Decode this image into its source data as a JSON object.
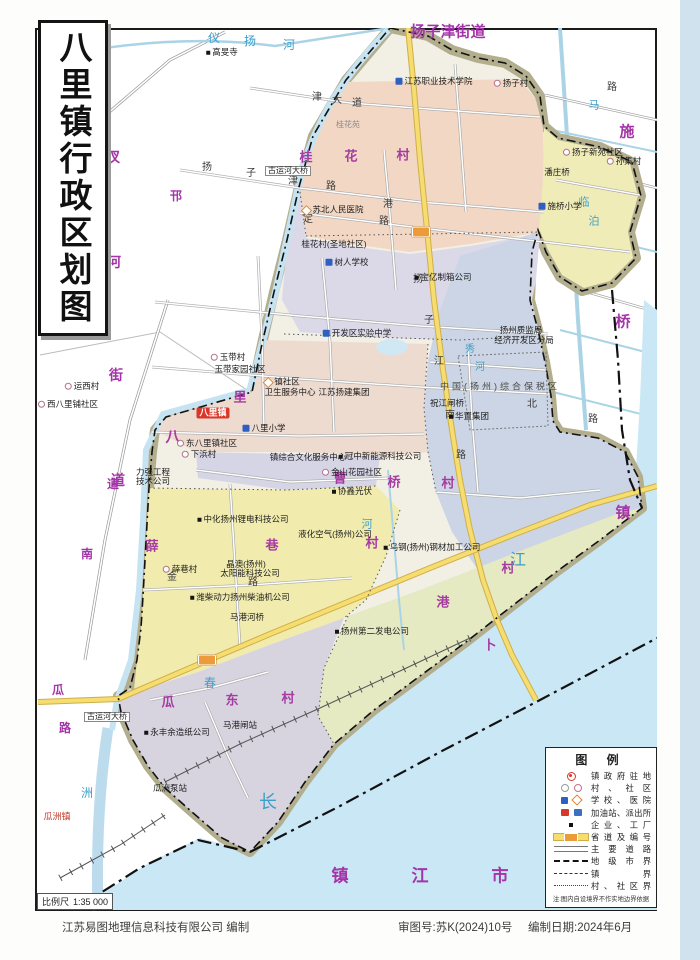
{
  "page": {
    "title": "八里镇行政区划图",
    "scale_label": "比例尺",
    "scale_value": "1:35 000",
    "credits": {
      "publisher": "江苏易图地理信息科技有限公司  编制",
      "approval": "审图号:苏K(2024)10号",
      "date": "编制日期:2024年6月"
    }
  },
  "colors": {
    "admin_purple": "#a335a8",
    "water_blue": "#c9e7f4",
    "levee_khaki": "#b2ae8e",
    "provincial_road_yellow": "#f6dd70",
    "shield_orange": "#ec9b3b",
    "seat_red": "#d8372a",
    "region_pink": "#f2d8c4",
    "region_yellow": "#f1ecae",
    "region_lavender": "#dbd9e8",
    "region_bluegray": "#ccd5e5",
    "region_green": "#e6eac2"
  },
  "legend": {
    "title": "图  例",
    "items": [
      {
        "icon": "govt",
        "label": "镇政府驻地"
      },
      {
        "icon": "village",
        "label": "村、社区"
      },
      {
        "icon": "school-hosp",
        "label": "学校、医院"
      },
      {
        "icon": "gas-police",
        "label": "加油站、派出所"
      },
      {
        "icon": "factory",
        "label": "企业、工厂"
      },
      {
        "icon": "sroad",
        "label": "省道及编号"
      },
      {
        "icon": "road",
        "label": "主要道路"
      },
      {
        "icon": "cityline",
        "label": "地级市界"
      },
      {
        "icon": "townline",
        "label": "镇界"
      },
      {
        "icon": "villine",
        "label": "村、社区界"
      }
    ],
    "note": "注:图内自设境界不作实地边界依据"
  },
  "map": {
    "admin_names": [
      {
        "name": "扬子津街道",
        "cls": "adm-lg",
        "chars": [
          {
            "c": "扬子津街道",
            "x": 448,
            "y": 32
          }
        ]
      },
      {
        "name": "汊河街道",
        "chars": [
          {
            "c": "汊",
            "x": 113,
            "y": 157
          },
          {
            "c": "河",
            "x": 114,
            "y": 262
          },
          {
            "c": "街",
            "x": 116,
            "y": 375
          },
          {
            "c": "道",
            "x": 118,
            "y": 480
          }
        ]
      },
      {
        "name": "施桥镇",
        "cls": "adm-lg",
        "chars": [
          {
            "c": "施",
            "x": 627,
            "y": 132
          },
          {
            "c": "桥",
            "x": 623,
            "y": 322
          },
          {
            "c": "镇",
            "x": 623,
            "y": 513
          }
        ]
      },
      {
        "name": "镇江市",
        "cls": "adm-city",
        "chars": [
          {
            "c": "镇",
            "x": 340,
            "y": 876
          },
          {
            "c": "江",
            "x": 420,
            "y": 876
          },
          {
            "c": "市",
            "x": 500,
            "y": 876
          }
        ]
      },
      {
        "name": "邗江",
        "chars": [
          {
            "c": "邗",
            "x": 176,
            "y": 196,
            "s": 12
          }
        ]
      },
      {
        "name": "瓜洲镇",
        "chars": [
          {
            "c": "镇",
            "x": 44,
            "y": 901,
            "s": 13
          }
        ]
      }
    ],
    "region_names": [
      {
        "name": "桂花村",
        "chars": [
          {
            "c": "桂",
            "x": 306,
            "y": 157
          },
          {
            "c": "花",
            "x": 351,
            "y": 156
          },
          {
            "c": "村",
            "x": 403,
            "y": 155
          }
        ]
      },
      {
        "name": "八里",
        "chars": [
          {
            "c": "八",
            "x": 173,
            "y": 437,
            "s": 15
          },
          {
            "c": "里",
            "x": 240,
            "y": 397
          }
        ]
      },
      {
        "name": "薛巷村",
        "chars": [
          {
            "c": "薛",
            "x": 152,
            "y": 546
          },
          {
            "c": "巷",
            "x": 272,
            "y": 545
          },
          {
            "c": "村",
            "x": 372,
            "y": 543
          }
        ]
      },
      {
        "name": "曹桥村",
        "chars": [
          {
            "c": "曹",
            "x": 340,
            "y": 478
          },
          {
            "c": "桥",
            "x": 394,
            "y": 482
          },
          {
            "c": "村",
            "x": 448,
            "y": 483
          }
        ]
      },
      {
        "name": "瓜东村",
        "chars": [
          {
            "c": "瓜",
            "x": 168,
            "y": 702
          },
          {
            "c": "东",
            "x": 232,
            "y": 700
          },
          {
            "c": "村",
            "x": 288,
            "y": 698
          }
        ]
      },
      {
        "name": "卜港村",
        "chars": [
          {
            "c": "村",
            "x": 508,
            "y": 568
          },
          {
            "c": "港",
            "x": 443,
            "y": 602
          },
          {
            "c": "卜",
            "x": 490,
            "y": 645
          }
        ]
      }
    ],
    "water_names": [
      {
        "name": "仪扬河",
        "chars": [
          {
            "c": "仪",
            "x": 214,
            "y": 38
          },
          {
            "c": "扬",
            "x": 250,
            "y": 41
          },
          {
            "c": "河",
            "x": 289,
            "y": 45
          }
        ]
      },
      {
        "name": "长江",
        "chars": [
          {
            "c": "长",
            "x": 268,
            "y": 802,
            "s": 18
          },
          {
            "c": "江",
            "x": 518,
            "y": 561,
            "s": 16
          }
        ]
      },
      {
        "name": "临泊",
        "chars": [
          {
            "c": "临",
            "x": 584,
            "y": 203,
            "s": 11
          },
          {
            "c": "泊",
            "x": 594,
            "y": 222,
            "s": 11
          }
        ]
      },
      {
        "name": "马",
        "chars": [
          {
            "c": "马",
            "x": 594,
            "y": 106,
            "s": 11
          }
        ]
      },
      {
        "name": "河",
        "chars": [
          {
            "c": "河",
            "x": 367,
            "y": 525,
            "s": 11
          }
        ]
      },
      {
        "name": "秀河",
        "chars": [
          {
            "c": "秀",
            "x": 470,
            "y": 350,
            "s": 10
          },
          {
            "c": "河",
            "x": 480,
            "y": 368,
            "s": 10
          }
        ]
      },
      {
        "name": "洲",
        "chars": [
          {
            "c": "洲",
            "x": 87,
            "y": 793
          }
        ]
      },
      {
        "name": "春",
        "chars": [
          {
            "c": "春",
            "x": 210,
            "y": 683
          }
        ]
      }
    ],
    "road_names": [
      {
        "name": "瓜洲路",
        "cls": "rd-purple",
        "chars": [
          {
            "c": "瓜",
            "x": 58,
            "y": 690
          },
          {
            "c": "路",
            "x": 65,
            "y": 728
          }
        ]
      },
      {
        "name": "南…道",
        "cls": "rd-purple",
        "chars": [
          {
            "c": "道",
            "x": 113,
            "y": 484
          },
          {
            "c": "南",
            "x": 87,
            "y": 554
          }
        ]
      },
      {
        "name": "扬子津路",
        "chars": [
          {
            "c": "扬",
            "x": 207,
            "y": 168
          },
          {
            "c": "子",
            "x": 251,
            "y": 174
          },
          {
            "c": "津",
            "x": 293,
            "y": 182
          },
          {
            "c": "路",
            "x": 331,
            "y": 187
          }
        ]
      },
      {
        "name": "津大道",
        "chars": [
          {
            "c": "津",
            "x": 317,
            "y": 98
          },
          {
            "c": "大",
            "x": 337,
            "y": 101
          },
          {
            "c": "道",
            "x": 357,
            "y": 104
          }
        ]
      },
      {
        "name": "定路",
        "chars": [
          {
            "c": "定",
            "x": 308,
            "y": 220
          }
        ]
      },
      {
        "name": "港路",
        "chars": [
          {
            "c": "港",
            "x": 388,
            "y": 205
          },
          {
            "c": "路",
            "x": 384,
            "y": 222
          }
        ]
      },
      {
        "name": "扬子江南路",
        "chars": [
          {
            "c": "扬",
            "x": 418,
            "y": 280
          },
          {
            "c": "子",
            "x": 429,
            "y": 321
          },
          {
            "c": "江",
            "x": 439,
            "y": 362
          },
          {
            "c": "南",
            "x": 450,
            "y": 416
          },
          {
            "c": "路",
            "x": 461,
            "y": 456
          }
        ]
      },
      {
        "name": "北…路",
        "chars": [
          {
            "c": "北",
            "x": 532,
            "y": 405
          },
          {
            "c": "路",
            "x": 593,
            "y": 420
          },
          {
            "c": "路",
            "x": 612,
            "y": 88
          }
        ]
      },
      {
        "name": "金…路",
        "chars": [
          {
            "c": "金",
            "x": 172,
            "y": 578
          },
          {
            "c": "路",
            "x": 253,
            "y": 583
          }
        ]
      }
    ],
    "places": [
      {
        "t": "高旻寺",
        "x": 222,
        "y": 52,
        "icon": "dot"
      },
      {
        "t": "江苏职业技术学院",
        "x": 434,
        "y": 81,
        "icon": "school"
      },
      {
        "t": "扬子村",
        "x": 511,
        "y": 83,
        "icon": "vil"
      },
      {
        "t": "扬子新苑社区",
        "x": 593,
        "y": 152,
        "icon": "vil"
      },
      {
        "t": "孙集村",
        "x": 624,
        "y": 161,
        "icon": "vil"
      },
      {
        "t": "潘庄桥",
        "x": 557,
        "y": 172
      },
      {
        "t": "施桥小学",
        "x": 560,
        "y": 206,
        "icon": "school"
      },
      {
        "t": "古运河大桥",
        "x": 288,
        "y": 171,
        "cls": "plc-box"
      },
      {
        "t": "苏北人民医院",
        "x": 333,
        "y": 210,
        "icon": "hosp"
      },
      {
        "t": "桂花村(圣地社区)",
        "x": 334,
        "y": 244
      },
      {
        "t": "树人学校",
        "x": 347,
        "y": 262,
        "icon": "school"
      },
      {
        "t": "宝亿制箱公司",
        "x": 443,
        "y": 277,
        "icon": "dot"
      },
      {
        "t": "开发区实验中学",
        "x": 357,
        "y": 333,
        "icon": "school"
      },
      {
        "t": "扬州质监局",
        "x": 521,
        "y": 330
      },
      {
        "t": "经济开发区分局",
        "x": 524,
        "y": 340
      },
      {
        "t": "中国(扬州)综合保税区",
        "x": 500,
        "y": 387,
        "cls": "plc-sp"
      },
      {
        "t": "祝江闸桥",
        "x": 447,
        "y": 403
      },
      {
        "t": "华置集团",
        "x": 469,
        "y": 416,
        "icon": "dot"
      },
      {
        "t": "冠中新能源科技公司",
        "x": 380,
        "y": 456,
        "icon": "dot"
      },
      {
        "t": "镇社区",
        "x": 282,
        "y": 382,
        "icon": "hosp"
      },
      {
        "t": "卫生服务中心",
        "x": 290,
        "y": 392
      },
      {
        "t": "江苏扬建集团",
        "x": 344,
        "y": 392
      },
      {
        "t": "玉带村",
        "x": 228,
        "y": 357,
        "icon": "vil"
      },
      {
        "t": "玉带家园社区",
        "x": 240,
        "y": 369
      },
      {
        "t": "八里镇",
        "x": 213,
        "y": 413,
        "cls": "seat"
      },
      {
        "t": "八里小学",
        "x": 264,
        "y": 428,
        "icon": "school"
      },
      {
        "t": "东八里镇社区",
        "x": 207,
        "y": 443,
        "icon": "vil"
      },
      {
        "t": "下浜村",
        "x": 199,
        "y": 454,
        "icon": "vil"
      },
      {
        "t": "镇综合文化服务中心",
        "x": 308,
        "y": 457
      },
      {
        "t": "金山花园社区",
        "x": 352,
        "y": 472,
        "icon": "vil"
      },
      {
        "t": "协鑫光伏",
        "x": 352,
        "y": 491,
        "icon": "dot"
      },
      {
        "t": "力强工程",
        "x": 153,
        "y": 472
      },
      {
        "t": "技术公司",
        "x": 153,
        "y": 481
      },
      {
        "t": "中化扬州锂电科技公司",
        "x": 243,
        "y": 519,
        "icon": "dot"
      },
      {
        "t": "晶澳(扬州)",
        "x": 246,
        "y": 564
      },
      {
        "t": "太阳能科技公司",
        "x": 250,
        "y": 573
      },
      {
        "t": "薛巷村",
        "x": 180,
        "y": 569,
        "icon": "vil"
      },
      {
        "t": "潍柴动力扬州柴油机公司",
        "x": 240,
        "y": 597,
        "icon": "dot"
      },
      {
        "t": "马港河桥",
        "x": 247,
        "y": 617
      },
      {
        "t": "乌钢(扬州)钢材加工公司",
        "x": 432,
        "y": 547,
        "icon": "dot"
      },
      {
        "t": "液化空气(扬州)公司",
        "x": 335,
        "y": 534
      },
      {
        "t": "扬州第二发电公司",
        "x": 372,
        "y": 631,
        "icon": "dot"
      },
      {
        "t": "永丰余造纸公司",
        "x": 177,
        "y": 732,
        "icon": "dot"
      },
      {
        "t": "马港闸站",
        "x": 240,
        "y": 725
      },
      {
        "t": "瓜洲泵站",
        "x": 170,
        "y": 788
      },
      {
        "t": "瓜洲镇",
        "x": 57,
        "y": 817,
        "cls": "plc-red"
      },
      {
        "t": "运西村",
        "x": 82,
        "y": 386,
        "icon": "vil"
      },
      {
        "t": "西八里铺社区",
        "x": 68,
        "y": 404,
        "icon": "vil"
      },
      {
        "t": "桂花苑",
        "x": 348,
        "y": 125,
        "cls": "plc-gray"
      },
      {
        "t": "古运河大桥",
        "x": 107,
        "y": 717,
        "cls": "plc-box"
      }
    ],
    "shields": [
      {
        "x": 421,
        "y": 232
      },
      {
        "x": 207,
        "y": 660
      }
    ]
  }
}
